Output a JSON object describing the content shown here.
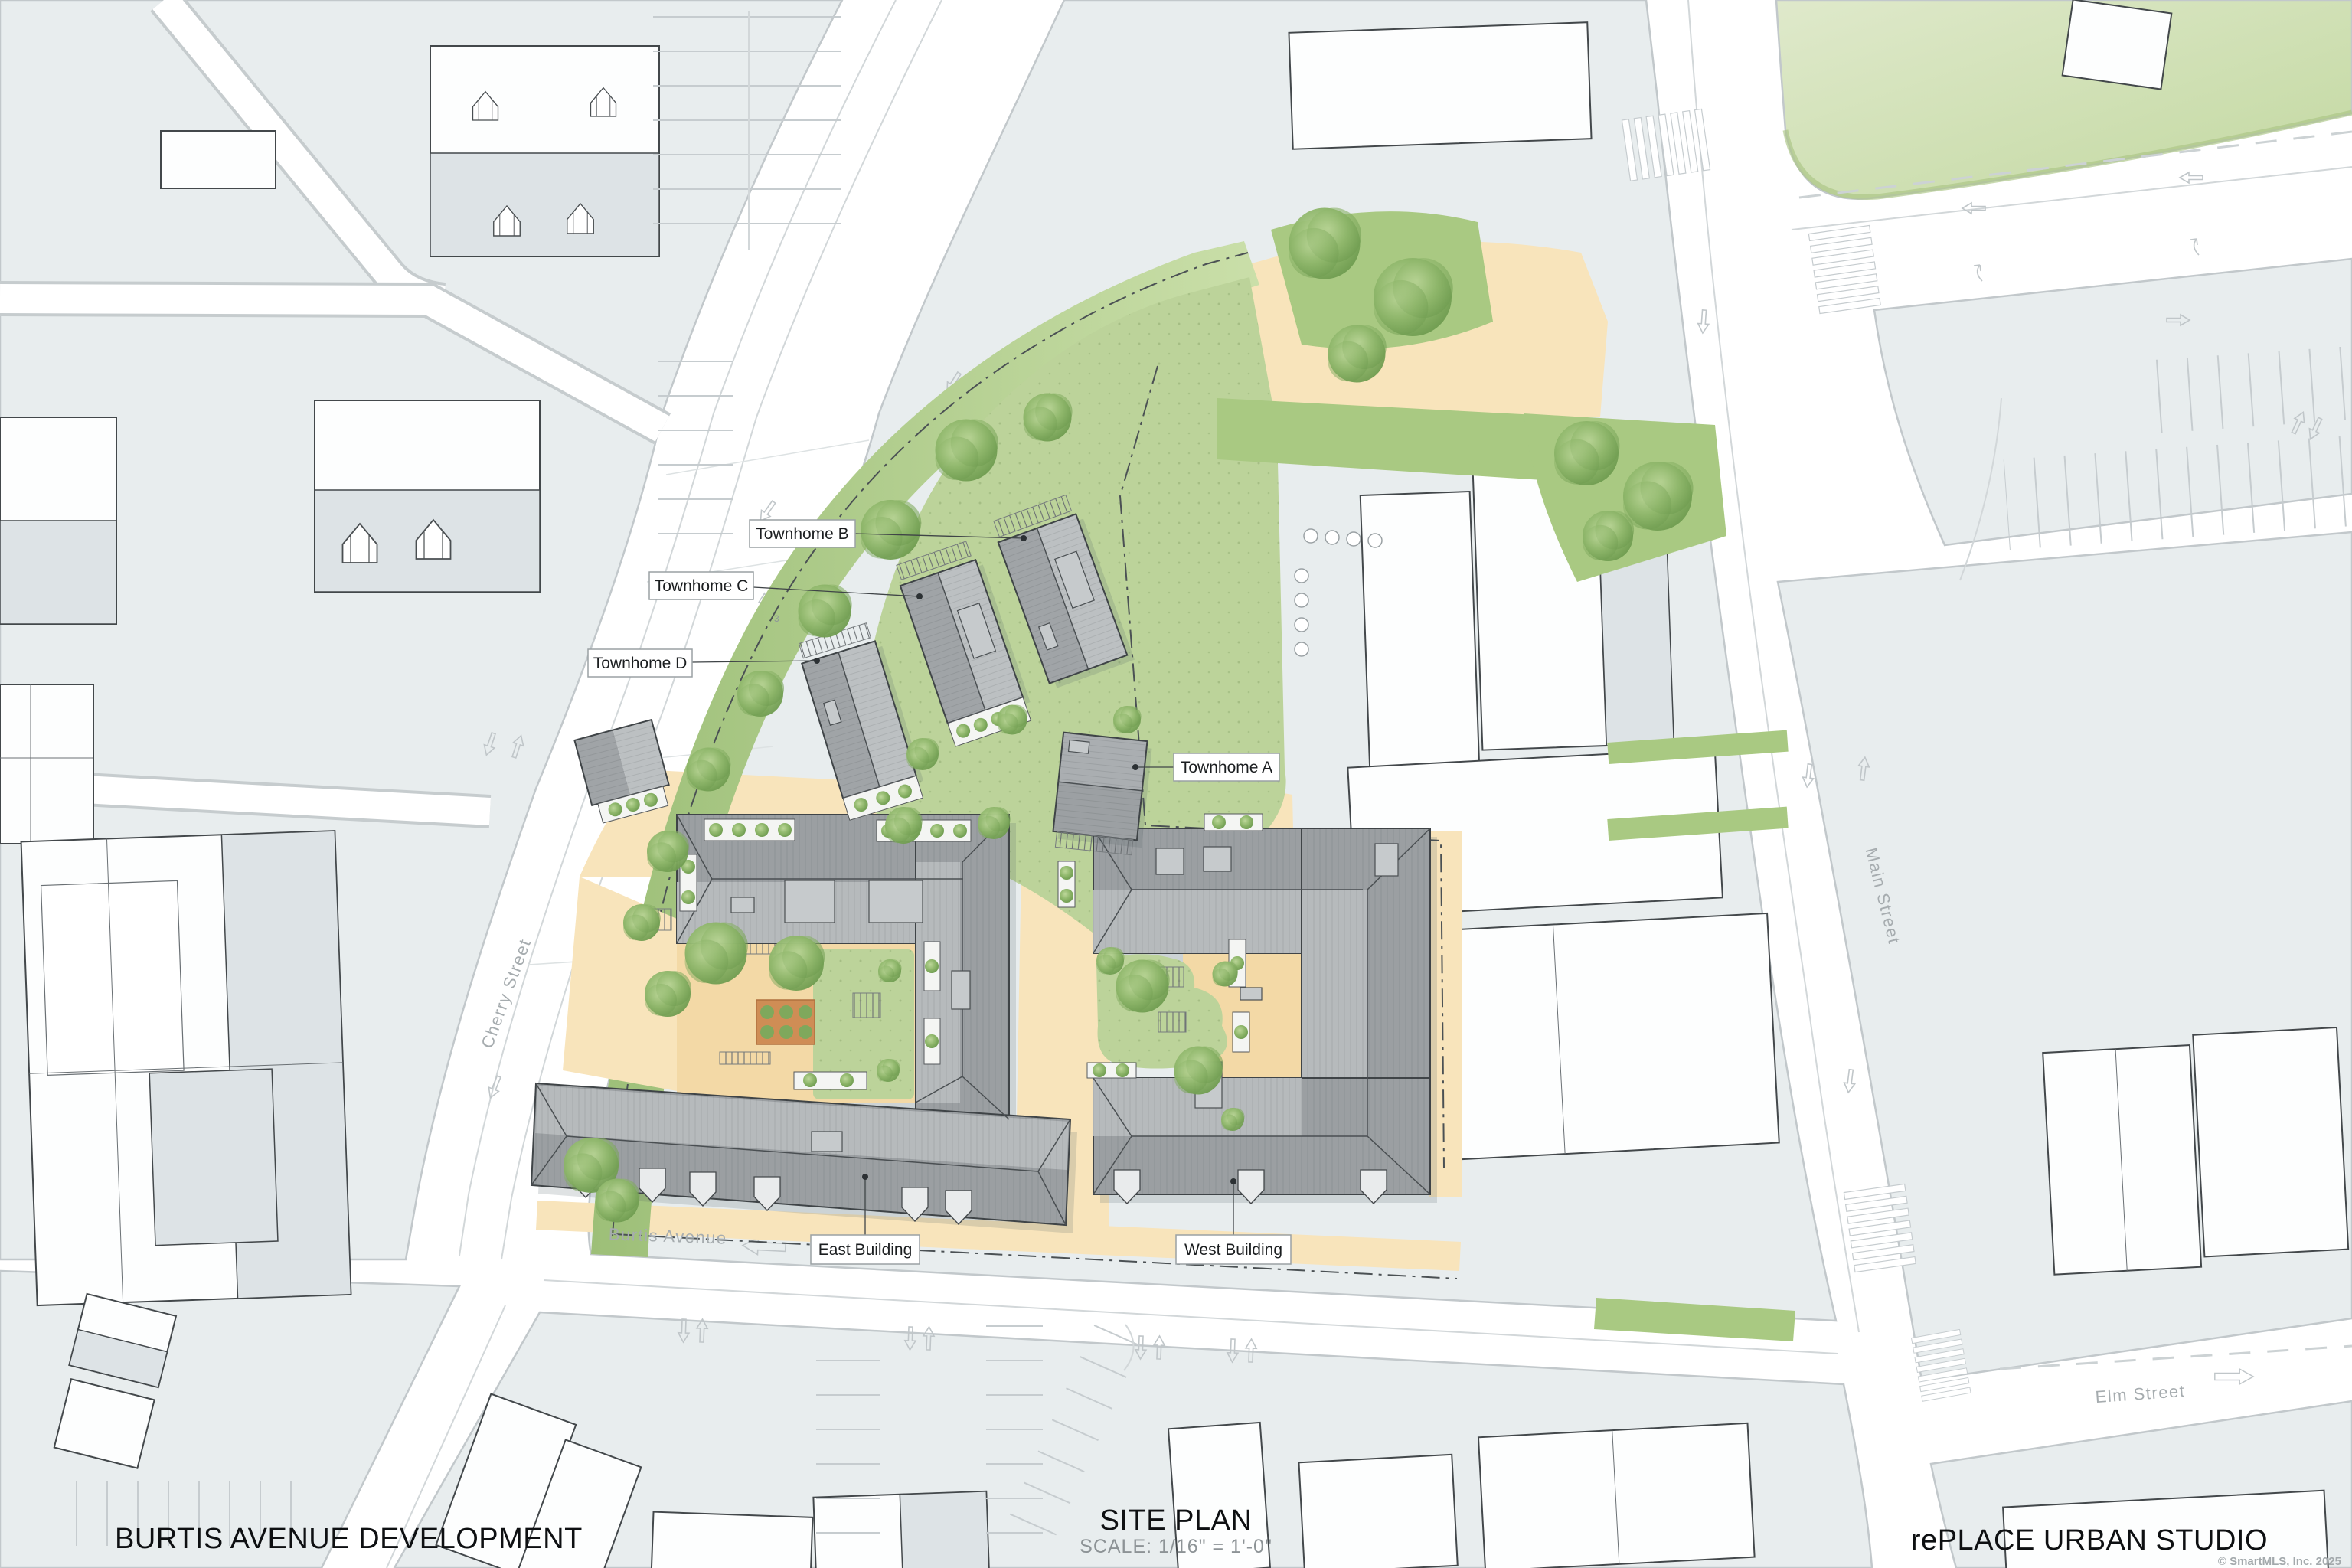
{
  "sheet": {
    "project_title": "BURTIS AVENUE DEVELOPMENT",
    "drawing_title": "SITE PLAN",
    "scale_note": "SCALE:  1/16\" = 1'-0\"",
    "firm_name": "rePLACE URBAN STUDIO",
    "copyright": "© SmartMLS, Inc.  2025"
  },
  "building_labels": {
    "townhome_a": "Townhome A",
    "townhome_b": "Townhome B",
    "townhome_c": "Townhome C",
    "townhome_d": "Townhome D",
    "east_building": "East Building",
    "west_building": "West Building"
  },
  "street_labels": {
    "cherry_street": "Cherry Street",
    "burtis_avenue": "Burtis Avenue",
    "main_street": "Main Street",
    "elm_street": "Elm Street"
  },
  "annotations": {
    "parcel_number": "3"
  },
  "colors": {
    "context_block": "#e8edee",
    "road_white": "#ffffff",
    "site_lawn": "#bcd39a",
    "park_green": "#d3e2ba",
    "paving_tan": "#f8e4bb",
    "roof_dark": "#9b9fa2",
    "roof_light": "#b6babc",
    "garden_soil": "#cf8d55",
    "tree_green": "#86ad63",
    "outline_dark": "#3f4447",
    "marking_gray": "#c6cccf",
    "street_text": "#a6acaf"
  }
}
